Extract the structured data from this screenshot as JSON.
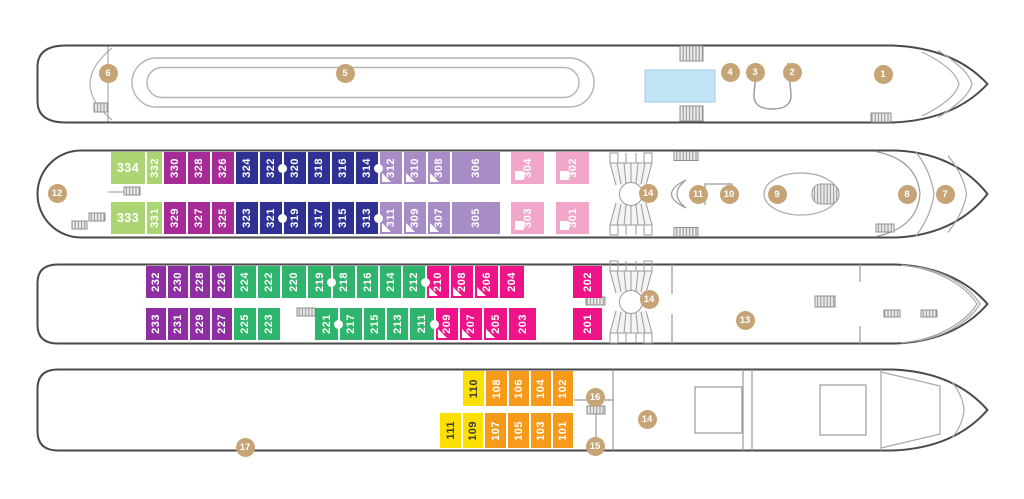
{
  "palette": {
    "green": "#abd573",
    "magenta": "#a62b96",
    "navy": "#2e3191",
    "lavender": "#a78cc5",
    "pink": "#f2a6ca",
    "purple": "#8f2da3",
    "emerald": "#2eb46d",
    "hotpink": "#ee1388",
    "yellow": "#fee000",
    "orange": "#f59a1b"
  },
  "marker_style": {
    "fill": "#c7a476",
    "text": "#ffffff"
  },
  "pool_fill": "#c0e3f5",
  "decks": [
    {
      "id": "sun-deck",
      "markers": [
        {
          "n": "1",
          "x": 883,
          "y": 74
        },
        {
          "n": "2",
          "x": 792,
          "y": 72
        },
        {
          "n": "3",
          "x": 755,
          "y": 72
        },
        {
          "n": "4",
          "x": 730,
          "y": 72
        },
        {
          "n": "5",
          "x": 345,
          "y": 73
        },
        {
          "n": "6",
          "x": 108,
          "y": 73
        }
      ],
      "rows": []
    },
    {
      "id": "deck-300",
      "markers": [
        {
          "n": "7",
          "x": 945,
          "y": 194
        },
        {
          "n": "8",
          "x": 907,
          "y": 194
        },
        {
          "n": "9",
          "x": 777,
          "y": 194
        },
        {
          "n": "10",
          "x": 729,
          "y": 194
        },
        {
          "n": "11",
          "x": 698,
          "y": 194
        },
        {
          "n": "12",
          "x": 57,
          "y": 193
        },
        {
          "n": "14",
          "x": 648,
          "y": 193
        }
      ],
      "rows": [
        {
          "y": 152,
          "h": 32,
          "x": 110,
          "cells": [
            {
              "n": "334",
              "c": "green",
              "w": 36,
              "horiz": true
            },
            {
              "n": "332",
              "c": "green",
              "w": 17
            },
            {
              "n": "330",
              "c": "magenta",
              "w": 24
            },
            {
              "n": "328",
              "c": "magenta",
              "w": 24
            },
            {
              "n": "326",
              "c": "magenta",
              "w": 24
            },
            {
              "n": "324",
              "c": "navy",
              "w": 24
            },
            {
              "n": "322",
              "c": "navy",
              "w": 24,
              "conn": true
            },
            {
              "n": "320",
              "c": "navy",
              "w": 24
            },
            {
              "n": "318",
              "c": "navy",
              "w": 24
            },
            {
              "n": "316",
              "c": "navy",
              "w": 24
            },
            {
              "n": "314",
              "c": "navy",
              "w": 24,
              "conn": true
            },
            {
              "n": "312",
              "c": "lavender",
              "w": 24,
              "tri": true
            },
            {
              "n": "310",
              "c": "lavender",
              "w": 24,
              "tri": true
            },
            {
              "n": "308",
              "c": "lavender",
              "w": 24,
              "tri": true
            },
            {
              "n": "306",
              "c": "lavender",
              "w": 50
            },
            {
              "gap": 9
            },
            {
              "n": "304",
              "c": "pink",
              "w": 35,
              "sq": true
            },
            {
              "gap": 10
            },
            {
              "n": "302",
              "c": "pink",
              "w": 35,
              "sq": true
            }
          ]
        },
        {
          "y": 202,
          "h": 32,
          "x": 110,
          "cells": [
            {
              "n": "333",
              "c": "green",
              "w": 36,
              "horiz": true
            },
            {
              "n": "331",
              "c": "green",
              "w": 17
            },
            {
              "n": "329",
              "c": "magenta",
              "w": 24
            },
            {
              "n": "327",
              "c": "magenta",
              "w": 24
            },
            {
              "n": "325",
              "c": "magenta",
              "w": 24
            },
            {
              "n": "323",
              "c": "navy",
              "w": 24
            },
            {
              "n": "321",
              "c": "navy",
              "w": 24,
              "conn": true
            },
            {
              "n": "319",
              "c": "navy",
              "w": 24
            },
            {
              "n": "317",
              "c": "navy",
              "w": 24
            },
            {
              "n": "315",
              "c": "navy",
              "w": 24
            },
            {
              "n": "313",
              "c": "navy",
              "w": 24,
              "conn": true
            },
            {
              "n": "311",
              "c": "lavender",
              "w": 24,
              "tri": true
            },
            {
              "n": "309",
              "c": "lavender",
              "w": 24,
              "tri": true
            },
            {
              "n": "307",
              "c": "lavender",
              "w": 24,
              "tri": true
            },
            {
              "n": "305",
              "c": "lavender",
              "w": 50
            },
            {
              "gap": 9
            },
            {
              "n": "303",
              "c": "pink",
              "w": 35,
              "sq": true
            },
            {
              "gap": 10
            },
            {
              "n": "301",
              "c": "pink",
              "w": 35,
              "sq": true
            }
          ]
        }
      ]
    },
    {
      "id": "deck-200",
      "markers": [
        {
          "n": "13",
          "x": 745,
          "y": 320
        },
        {
          "n": "14",
          "x": 649,
          "y": 299
        }
      ],
      "rows": [
        {
          "y": 266,
          "h": 32,
          "x": 145,
          "cells": [
            {
              "n": "232",
              "c": "purple",
              "w": 22
            },
            {
              "n": "230",
              "c": "purple",
              "w": 22
            },
            {
              "n": "228",
              "c": "purple",
              "w": 22
            },
            {
              "n": "226",
              "c": "purple",
              "w": 22
            },
            {
              "n": "224",
              "c": "emerald",
              "w": 24
            },
            {
              "n": "222",
              "c": "emerald",
              "w": 24
            },
            {
              "n": "220",
              "c": "emerald",
              "w": 26
            },
            {
              "n": "219",
              "c": "emerald",
              "w": 25,
              "conn": true
            },
            {
              "n": "218",
              "c": "emerald",
              "w": 24
            },
            {
              "n": "216",
              "c": "emerald",
              "w": 23
            },
            {
              "n": "214",
              "c": "emerald",
              "w": 23
            },
            {
              "n": "212",
              "c": "emerald",
              "w": 24,
              "conn": true
            },
            {
              "n": "210",
              "c": "hotpink",
              "w": 24,
              "tri": true
            },
            {
              "n": "208",
              "c": "hotpink",
              "w": 24,
              "tri": true
            },
            {
              "n": "206",
              "c": "hotpink",
              "w": 25,
              "tri": true
            },
            {
              "n": "204",
              "c": "hotpink",
              "w": 26
            },
            {
              "gap": 47
            },
            {
              "n": "202",
              "c": "hotpink",
              "w": 31
            }
          ]
        },
        {
          "y": 308,
          "h": 32,
          "x": 145,
          "cells": [
            {
              "n": "233",
              "c": "purple",
              "w": 22
            },
            {
              "n": "231",
              "c": "purple",
              "w": 22
            },
            {
              "n": "229",
              "c": "purple",
              "w": 22
            },
            {
              "n": "227",
              "c": "purple",
              "w": 22
            },
            {
              "n": "225",
              "c": "emerald",
              "w": 24
            },
            {
              "n": "223",
              "c": "emerald",
              "w": 24
            },
            {
              "gap": 33
            },
            {
              "n": "221",
              "c": "emerald",
              "w": 25,
              "conn": true
            },
            {
              "n": "217",
              "c": "emerald",
              "w": 24
            },
            {
              "n": "215",
              "c": "emerald",
              "w": 23
            },
            {
              "n": "213",
              "c": "emerald",
              "w": 23
            },
            {
              "n": "211",
              "c": "emerald",
              "w": 26,
              "conn": true
            },
            {
              "n": "209",
              "c": "hotpink",
              "w": 24,
              "tri": true
            },
            {
              "n": "207",
              "c": "hotpink",
              "w": 24,
              "tri": true
            },
            {
              "n": "205",
              "c": "hotpink",
              "w": 25,
              "tri": true
            },
            {
              "n": "203",
              "c": "hotpink",
              "w": 29
            },
            {
              "gap": 35
            },
            {
              "n": "201",
              "c": "hotpink",
              "w": 31
            }
          ]
        }
      ]
    },
    {
      "id": "deck-100",
      "markers": [
        {
          "n": "14",
          "x": 647,
          "y": 419
        },
        {
          "n": "15",
          "x": 595,
          "y": 446
        },
        {
          "n": "16",
          "x": 595,
          "y": 397
        },
        {
          "n": "17",
          "x": 245,
          "y": 447
        }
      ],
      "rows": [
        {
          "y": 371,
          "h": 35,
          "x": 462,
          "cells": [
            {
              "n": "110",
              "c": "yellow",
              "w": 23
            },
            {
              "n": "108",
              "c": "orange",
              "w": 23
            },
            {
              "n": "106",
              "c": "orange",
              "w": 22
            },
            {
              "n": "104",
              "c": "orange",
              "w": 22
            },
            {
              "n": "102",
              "c": "orange",
              "w": 22
            }
          ]
        },
        {
          "y": 413,
          "h": 35,
          "x": 439,
          "cells": [
            {
              "n": "111",
              "c": "yellow",
              "w": 23
            },
            {
              "n": "109",
              "c": "yellow",
              "w": 22
            },
            {
              "n": "107",
              "c": "orange",
              "w": 23
            },
            {
              "n": "105",
              "c": "orange",
              "w": 23
            },
            {
              "n": "103",
              "c": "orange",
              "w": 22
            },
            {
              "n": "101",
              "c": "orange",
              "w": 22
            }
          ]
        }
      ]
    }
  ]
}
